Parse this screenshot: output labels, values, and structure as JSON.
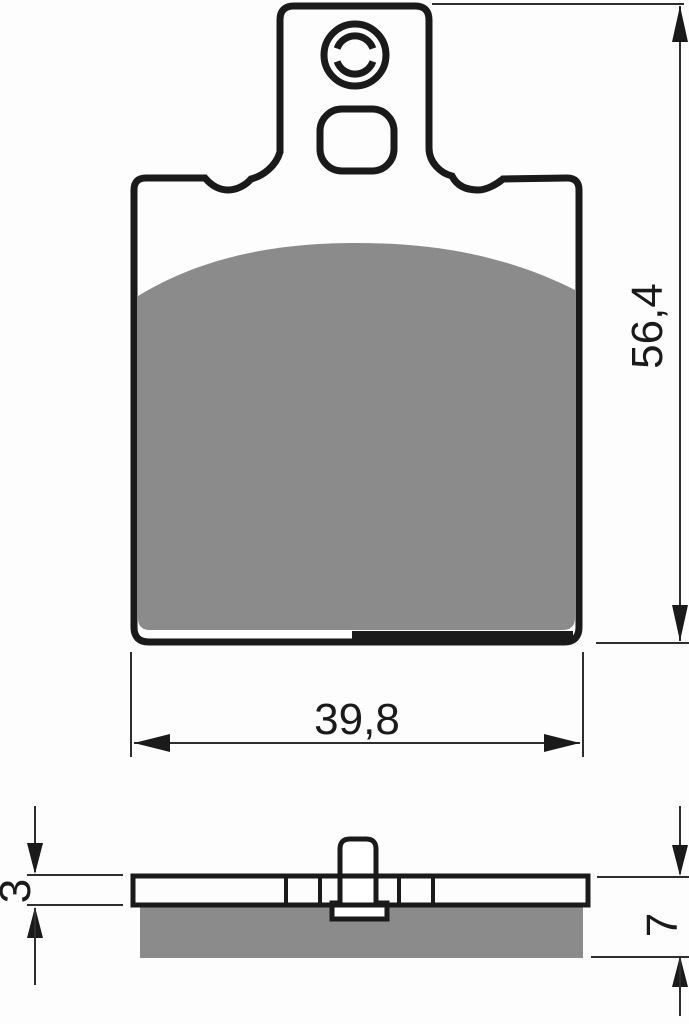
{
  "drawing": {
    "front_view": {
      "height_dim": "56,4",
      "width_dim": "39,8"
    },
    "side_view": {
      "backplate_thickness_dim": "3",
      "total_thickness_dim": "7"
    },
    "colors": {
      "outline": "#1a1a1a",
      "dim_line": "#2e2e2e",
      "friction_material": "#8b8b8b",
      "background": "#fdfdfd"
    }
  }
}
